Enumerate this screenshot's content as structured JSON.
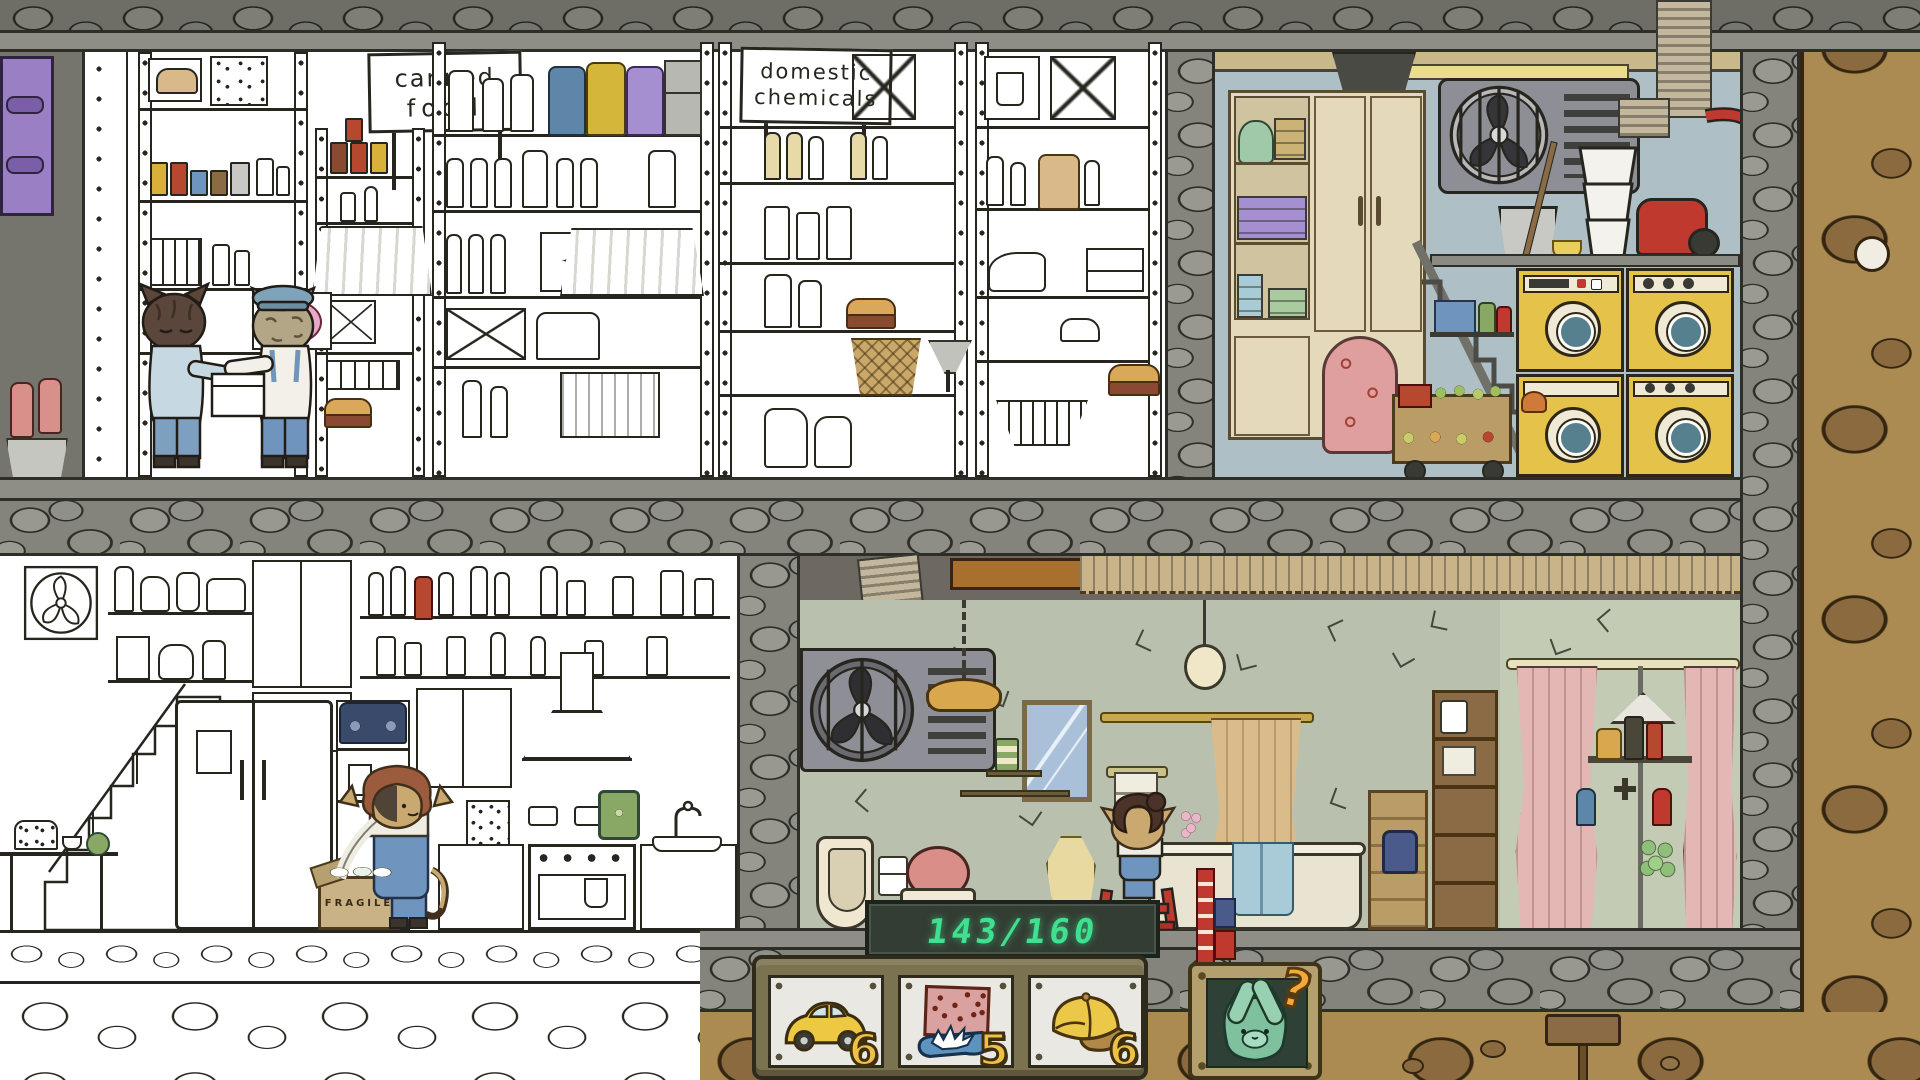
{
  "palette": {
    "ink": "#26261f",
    "led_green": "#3fe08f",
    "counter_board": "#333d33",
    "count_yellow": "#eec043",
    "count_outline": "#3f2f12",
    "hint_orange": "#f2a93b",
    "hint_board": "#2f4136",
    "hint_frame": "#b49f6e",
    "hint_cat": "#7fc09e",
    "tray_olive": "#7b7252",
    "plate": "#eae8e2",
    "beam": "#8e8e87",
    "earth": "#ab8b52",
    "earth_rock": "#8a6a3e",
    "laundry_wall": "#aebfc6",
    "bathroom_wall": "#b9c0ae",
    "shower_wall": "#c3cbb4",
    "closet_cream": "#e4d9bb",
    "washer_yellow": "#e5c24a",
    "washer_glass": "#57808e",
    "vacuum_red": "#c0392f",
    "pipe_copper": "#a8702e",
    "curtain_tan": "#d9bc8a",
    "curtain_pink": "#e3b7b4",
    "toilet_pink": "#d98f88",
    "towel_purple": "#a58fd0",
    "towel_green": "#a8cba0",
    "towel_blue": "#a9cbd8",
    "ironing_pink": "#df9f9e",
    "purple_panel": "#9a7fc5",
    "glove_pink": "#d98f8a",
    "car_yellow": "#ecc843",
    "cap_yellow": "#ecc848",
    "item_towel_pink": "#d9a1a0",
    "water_blue": "#5e93c0",
    "radio_navy": "#3a4a6b",
    "watering_can_green": "#8aa865",
    "overalls_blue": "#6f94bd",
    "cat_auburn": "#9c5b3c",
    "cat_tan": "#c9a96f",
    "cat_dark": "#5a463a",
    "sailor_cap": "#7fa3b8"
  },
  "hud": {
    "counter": "143/160",
    "question_mark": "?",
    "items": [
      {
        "name": "yellow-car",
        "count": "6"
      },
      {
        "name": "splashing-polka-dot-towel",
        "count": "5"
      },
      {
        "name": "yellow-cap",
        "count": "6"
      }
    ]
  },
  "signs": {
    "canned_food": [
      "canned",
      "food"
    ],
    "domestic_chemicals": [
      "domestic",
      "chemicals"
    ]
  },
  "labels": {
    "fragile": "FRAGILE"
  }
}
